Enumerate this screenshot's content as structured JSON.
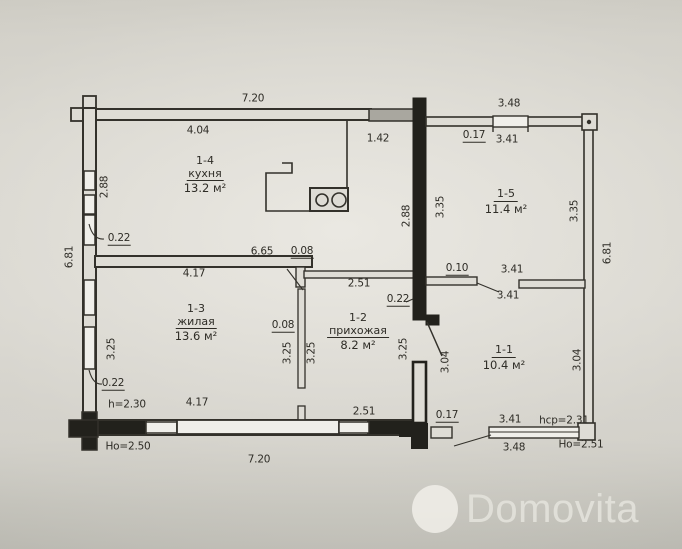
{
  "watermark": {
    "brand": "Domovita",
    "icon": "circle"
  },
  "colors": {
    "paper": "#d8d6cf",
    "line": "#33312b",
    "solid_wall": "#22211c",
    "gray_wall_block": "#a9a79f",
    "watermark": "#e7e6e0"
  },
  "plan": {
    "rooms": [
      {
        "num": "1-4",
        "name": "кухня",
        "area": "13.2 м²",
        "x": 205,
        "y": 155
      },
      {
        "num": "1-5",
        "name": "",
        "area": "11.4 м²",
        "x": 506,
        "y": 188
      },
      {
        "num": "1-3",
        "name": "жилая",
        "area": "13.6 м²",
        "x": 196,
        "y": 303
      },
      {
        "num": "1-2",
        "name": "прихожая",
        "area": "8.2 м²",
        "x": 358,
        "y": 312
      },
      {
        "num": "1-1",
        "name": "",
        "area": "10.4 м²",
        "x": 504,
        "y": 344
      }
    ],
    "dim_labels": [
      {
        "t": "7.20",
        "x": 253,
        "y": 99
      },
      {
        "t": "3.48",
        "x": 509,
        "y": 104
      },
      {
        "t": "4.04",
        "x": 198,
        "y": 131
      },
      {
        "t": "1.42",
        "x": 378,
        "y": 139
      },
      {
        "t": "0.17",
        "x": 474,
        "y": 136,
        "ul": 1
      },
      {
        "t": "3.41",
        "x": 507,
        "y": 140
      },
      {
        "t": "0.22",
        "x": 119,
        "y": 239,
        "ul": 1
      },
      {
        "t": "6.65",
        "x": 262,
        "y": 252
      },
      {
        "t": "0.08",
        "x": 302,
        "y": 252,
        "ul": 1
      },
      {
        "t": "4.17",
        "x": 194,
        "y": 274
      },
      {
        "t": "2.51",
        "x": 359,
        "y": 284
      },
      {
        "t": "0.10",
        "x": 457,
        "y": 269,
        "ul": 1
      },
      {
        "t": "3.41",
        "x": 512,
        "y": 270
      },
      {
        "t": "3.41",
        "x": 508,
        "y": 296
      },
      {
        "t": "0.22",
        "x": 398,
        "y": 300,
        "ul": 1
      },
      {
        "t": "0.08",
        "x": 283,
        "y": 326,
        "ul": 1
      },
      {
        "t": "2.88",
        "x": 105,
        "y": 187,
        "r": -90
      },
      {
        "t": "2.88",
        "x": 407,
        "y": 216,
        "r": -90
      },
      {
        "t": "6.81",
        "x": 70,
        "y": 257,
        "r": -90
      },
      {
        "t": "6.81",
        "x": 608,
        "y": 253,
        "r": -90
      },
      {
        "t": "3.35",
        "x": 441,
        "y": 207,
        "r": -90
      },
      {
        "t": "3.35",
        "x": 575,
        "y": 211,
        "r": -90
      },
      {
        "t": "3.25",
        "x": 112,
        "y": 349,
        "r": -90
      },
      {
        "t": "3.25",
        "x": 288,
        "y": 353,
        "r": -90
      },
      {
        "t": "3.25",
        "x": 312,
        "y": 353,
        "r": -90
      },
      {
        "t": "3.25",
        "x": 404,
        "y": 349,
        "r": -90
      },
      {
        "t": "3.04",
        "x": 446,
        "y": 362,
        "r": -90
      },
      {
        "t": "3.04",
        "x": 578,
        "y": 360,
        "r": -90
      },
      {
        "t": "0.22",
        "x": 113,
        "y": 384,
        "ul": 1
      },
      {
        "t": "h=2.30",
        "x": 127,
        "y": 405
      },
      {
        "t": "4.17",
        "x": 197,
        "y": 403
      },
      {
        "t": "2.51",
        "x": 364,
        "y": 412
      },
      {
        "t": "0.17",
        "x": 447,
        "y": 416,
        "ul": 1
      },
      {
        "t": "3.41",
        "x": 510,
        "y": 420
      },
      {
        "t": "hcp=2.31",
        "x": 564,
        "y": 421
      },
      {
        "t": "Ho=2.50",
        "x": 128,
        "y": 447
      },
      {
        "t": "7.20",
        "x": 259,
        "y": 460
      },
      {
        "t": "3.48",
        "x": 514,
        "y": 448
      },
      {
        "t": "Ho=2.51",
        "x": 581,
        "y": 445
      }
    ]
  }
}
